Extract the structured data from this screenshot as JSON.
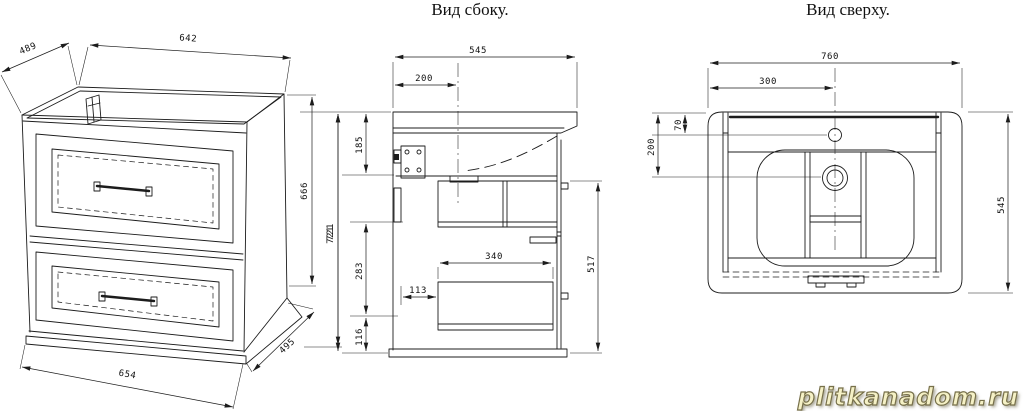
{
  "titles": {
    "side_view": "Вид сбоку.",
    "top_view": "Вид сверху."
  },
  "watermark": {
    "text": "plitkanadom.ru",
    "fill": "#f5f1c6",
    "outline": "#77704a"
  },
  "colors": {
    "line": "#1c1c1c",
    "background": "#ffffff"
  },
  "front_view": {
    "dims": {
      "top_depth": "489",
      "top_width": "642",
      "side_height": "666",
      "overall_height": "721",
      "bottom_width": "654",
      "bottom_depth": "495"
    }
  },
  "side_view": {
    "dims": {
      "overall_depth": "545",
      "basin_center_offset": "200",
      "counter_to_bracket": "185",
      "mid_section": "283",
      "bottom_section": "116",
      "overall_height": "721",
      "drawer_inset": "113",
      "drawer_depth": "340",
      "front_height": "517"
    }
  },
  "top_view": {
    "dims": {
      "overall_width": "760",
      "faucet_offset_x": "300",
      "faucet_offset_y": "70",
      "drain_offset_y": "200",
      "overall_depth": "545"
    }
  }
}
